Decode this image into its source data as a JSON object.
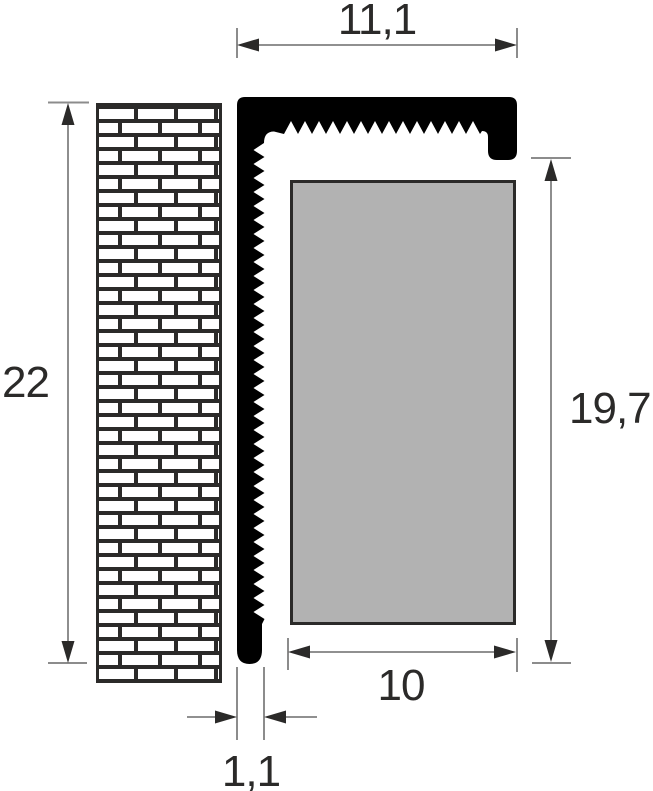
{
  "drawing": {
    "labels": {
      "top_width": "11,1",
      "left_height": "22",
      "right_height": "19,7",
      "bottom_width": "10",
      "profile_thickness": "1,1"
    },
    "colors": {
      "profile_fill": "#000000",
      "panel_fill": "#b2b2b2",
      "outline_dark": "#2b2a29",
      "dimension_line": "#818181",
      "background": "#ffffff"
    }
  }
}
